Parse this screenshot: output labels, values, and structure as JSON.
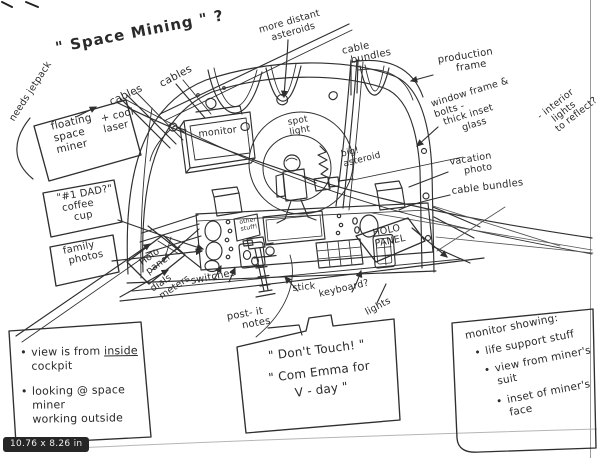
{
  "app": {
    "size_badge": "10.76 x 8.26 in"
  },
  "sketch": {
    "title": "\" Space Mining \" ?",
    "labels": {
      "needs_jetpack": "needs jetpack",
      "cables_a": "cables",
      "cables_b": "cables",
      "more_distant": "more distant\n   asteroids",
      "cable_bundles_top": "cable\n  bundles",
      "production_frame": "production\n     frame",
      "window_frame": "window frame &\nbolts -\n  thick inset\n       glass",
      "interior_lights": "- interior\n   lights\n  to reflect?",
      "vacation_photo": "vacation\n    photo",
      "cable_bundles_right": "cable bundles",
      "monitor": "monitor",
      "spot_light": "spot\nlight",
      "big_asteroid": "big!\nasteroid",
      "other_stuff": "other\nstuff!",
      "holo_panel_left": "Holo\npanel",
      "holo_panel_right": "HOLO\nPANEL",
      "dials_meters": "dials\n meters",
      "switches": "switches",
      "stick": "stick",
      "keyboard": "keyboard?",
      "lights": "lights",
      "post_it_notes": "post- it\n    notes"
    },
    "callouts": {
      "floating_main": "floating\nspace\nminer",
      "floating_side": "+ cool\nlaser",
      "dad_cup": "\"#1 DAD?\"\n coffee\n    cup",
      "family_photos": "family\n photos",
      "notes": {
        "b1_pre": "view is from ",
        "b1_underline": "inside",
        "b1_post": " cockpit",
        "b2": "looking @ space miner\nworking outside"
      },
      "dont_touch": {
        "line1": "\" Don't Touch! \"",
        "line2": "\" Com Emma for\nV - day \""
      },
      "monitor_showing": {
        "title": "monitor showing:",
        "bullets": [
          "life support stuff",
          "view from miner's\nsuit",
          "inset of miner's\nface"
        ]
      }
    }
  }
}
